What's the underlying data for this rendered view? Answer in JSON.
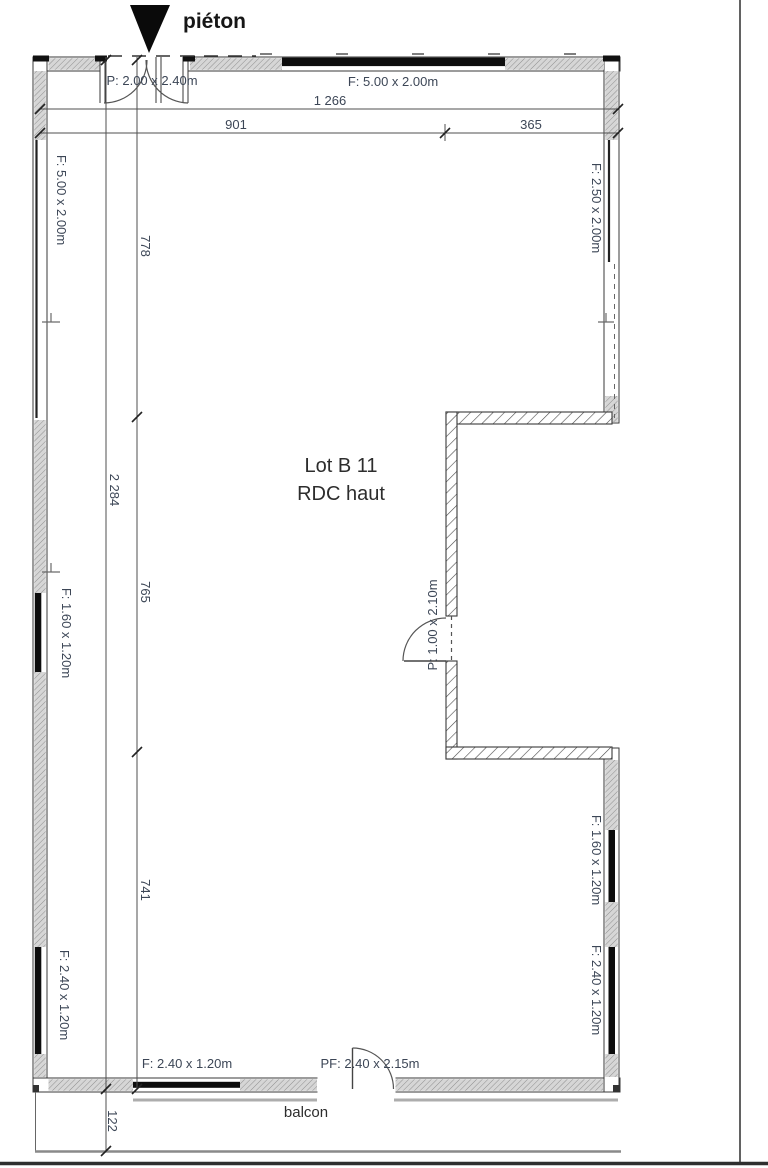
{
  "plan": {
    "pedestrian_label": "piéton",
    "unit_title": "Lot B 11",
    "unit_subtitle": "RDC haut",
    "balcony_label": "balcon",
    "entrance_door_label": "P: 2.00 x 2.40m",
    "interior_door_label": "P: 1.00 x 2.10m",
    "balcony_door_label": "PF: 2.40 x 2.15m",
    "windows": {
      "top": "F: 5.00 x 2.00m",
      "left_upper": "F: 5.00 x 2.00m",
      "left_middle": "F: 1.60 x 1.20m",
      "left_lower": "F: 2.40 x 1.20m",
      "right_upper": "F: 2.50 x 2.00m",
      "right_middle": "F: 1.60 x 1.20m",
      "right_lower": "F: 2.40 x 1.20m",
      "bottom": "F: 2.40 x 1.20m"
    },
    "dimensions": {
      "total_width": "1 266",
      "width_left": "901",
      "width_right": "365",
      "total_height": "2 284",
      "height_top": "778",
      "height_middle": "765",
      "height_bottom": "741",
      "balcony_depth": "122"
    }
  }
}
